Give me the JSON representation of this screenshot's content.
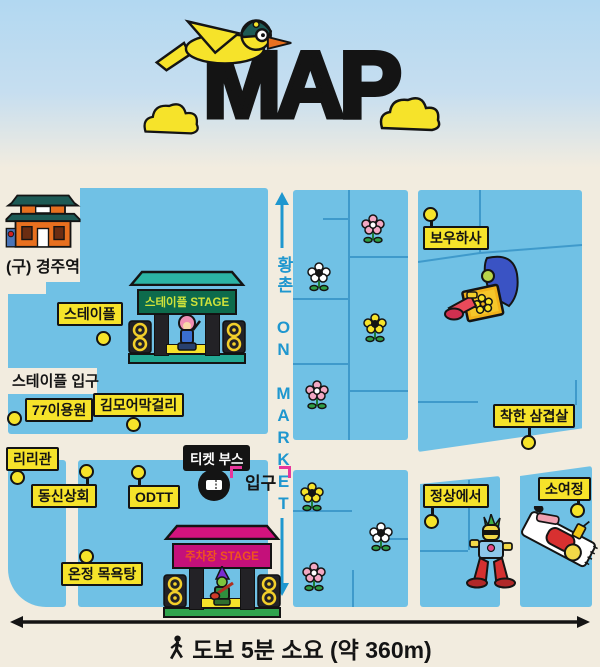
{
  "title": "MAP",
  "street": {
    "label": "황촌 ON MARKET"
  },
  "station": {
    "label": "(구) 경주역"
  },
  "entrance_note": "스테이플 입구",
  "ticket": {
    "booth_label": "티켓 부스",
    "entrance_label": "입구"
  },
  "stages": [
    {
      "label": "스테이플 STAGE"
    },
    {
      "label": "주차장 STAGE"
    }
  ],
  "places": [
    {
      "label": "스테이플"
    },
    {
      "label": "77이용원"
    },
    {
      "label": "김모어막걸리"
    },
    {
      "label": "리리관"
    },
    {
      "label": "동신상회"
    },
    {
      "label": "ODTT"
    },
    {
      "label": "온정 목욕탕"
    },
    {
      "label": "보우하사"
    },
    {
      "label": "착한 삼겹살"
    },
    {
      "label": "정상에서"
    },
    {
      "label": "소여정"
    }
  ],
  "footer": {
    "walk_note": "도보 5분 소요 (약 360m)"
  },
  "colors": {
    "block_blue": "#70c1e5",
    "background_cream": "#f2ecdf",
    "label_yellow": "#f6e32a",
    "street_text_blue": "#1f97cf",
    "stage1_banner_green": "#0d6b4c",
    "stage1_text": "#cfe23a",
    "stage2_banner_magenta": "#c4107a",
    "stage2_text": "#f0541e",
    "entrance_bracket_pink": "#e8359b"
  }
}
